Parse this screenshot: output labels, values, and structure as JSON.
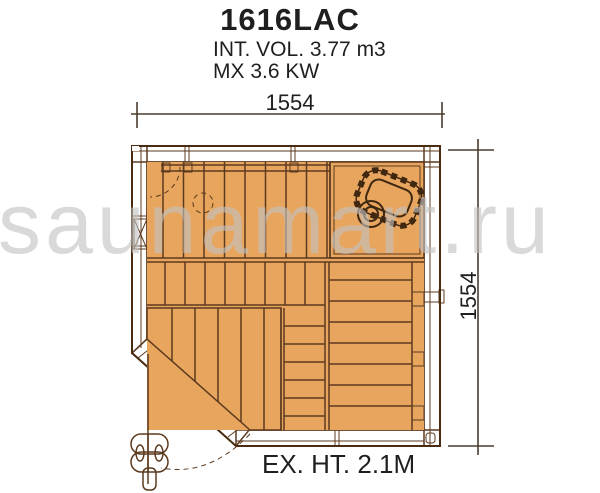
{
  "header": {
    "title": "1616LAC",
    "spec_line1": "INT. VOL. 3.77 m3",
    "spec_line2": "MX 3.6 KW"
  },
  "dimensions": {
    "width_label": "1554",
    "height_label": "1554"
  },
  "footer": {
    "exterior_height_label": "EX. HT. 2.1M"
  },
  "watermark": {
    "text": "saunamart.ru"
  },
  "icons": {
    "heater": "heater-with-stones-top-view",
    "vent": "heater-vent-circle",
    "door_handle": "door-handle-top-view",
    "door_swing": "door-swing-dashed-arc",
    "wall_brace": "x-brace-wall-joint",
    "vents_dashed": "dashed-circle-and-quarter-arc-vents"
  },
  "colors": {
    "wood": "#E8A55E",
    "wood_dark": "#BC7A46",
    "floor": "#CA6638",
    "outline": "#5C3A1E",
    "outline_strong": "#482B10",
    "heater_outline": "#3F2710",
    "dim_line": "#4C3B2C",
    "text": "#1F1F1F",
    "watermark": "#C2C2C2"
  }
}
